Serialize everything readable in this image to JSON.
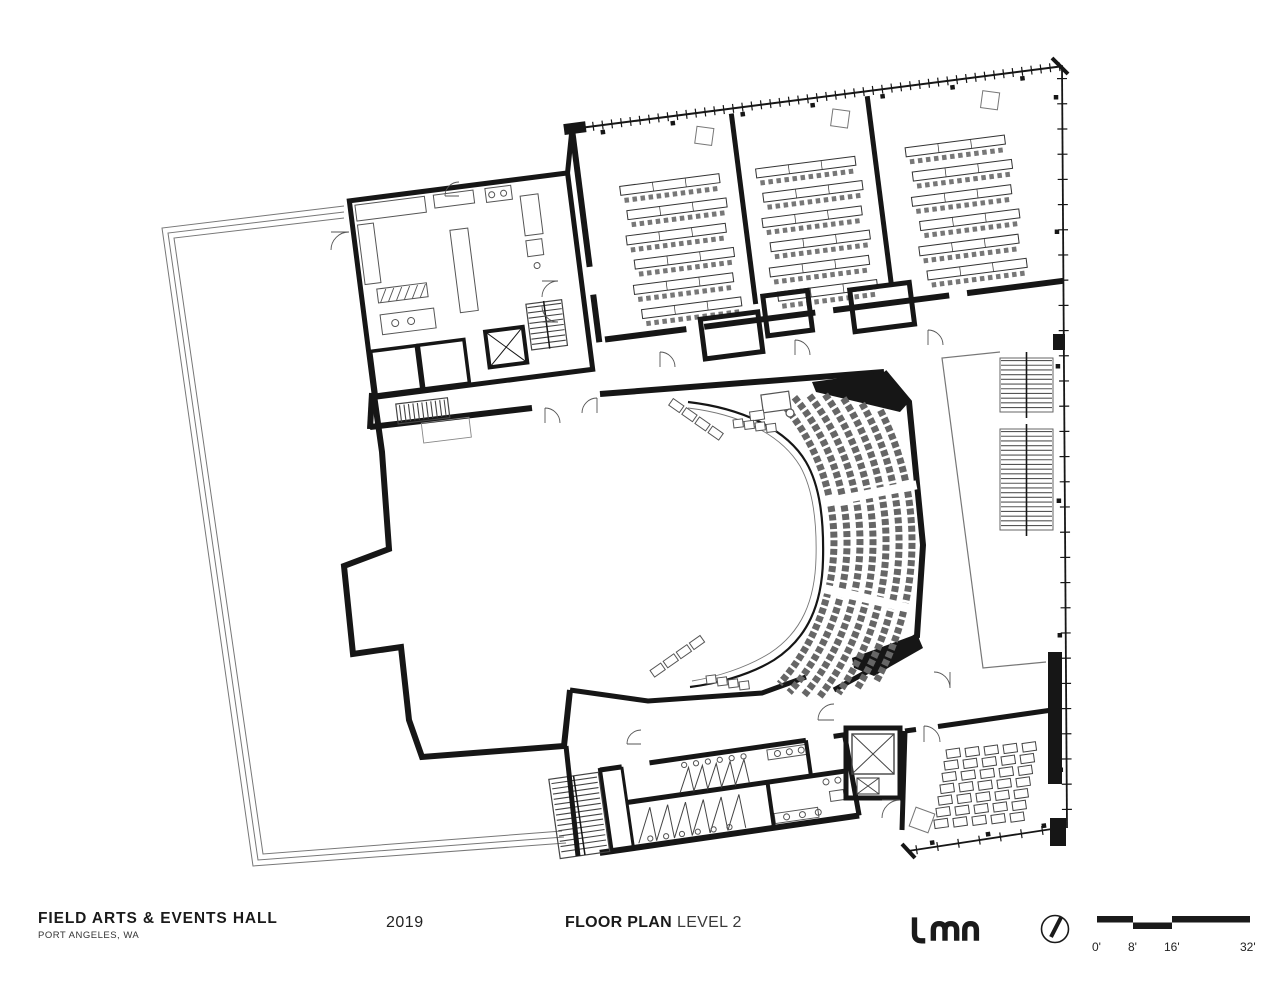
{
  "titleblock": {
    "project_title": "FIELD ARTS & EVENTS HALL",
    "project_location": "PORT ANGELES, WA",
    "year": "2019",
    "sheet_title": "FLOOR PLAN",
    "sheet_subtitle": "LEVEL 2",
    "firm_name": "LMN"
  },
  "scale_bar": {
    "labels": [
      "0'",
      "8'",
      "16'",
      "32'"
    ]
  },
  "colors": {
    "ink": "#161616",
    "paper": "#ffffff",
    "furniture_line": "#555555"
  }
}
